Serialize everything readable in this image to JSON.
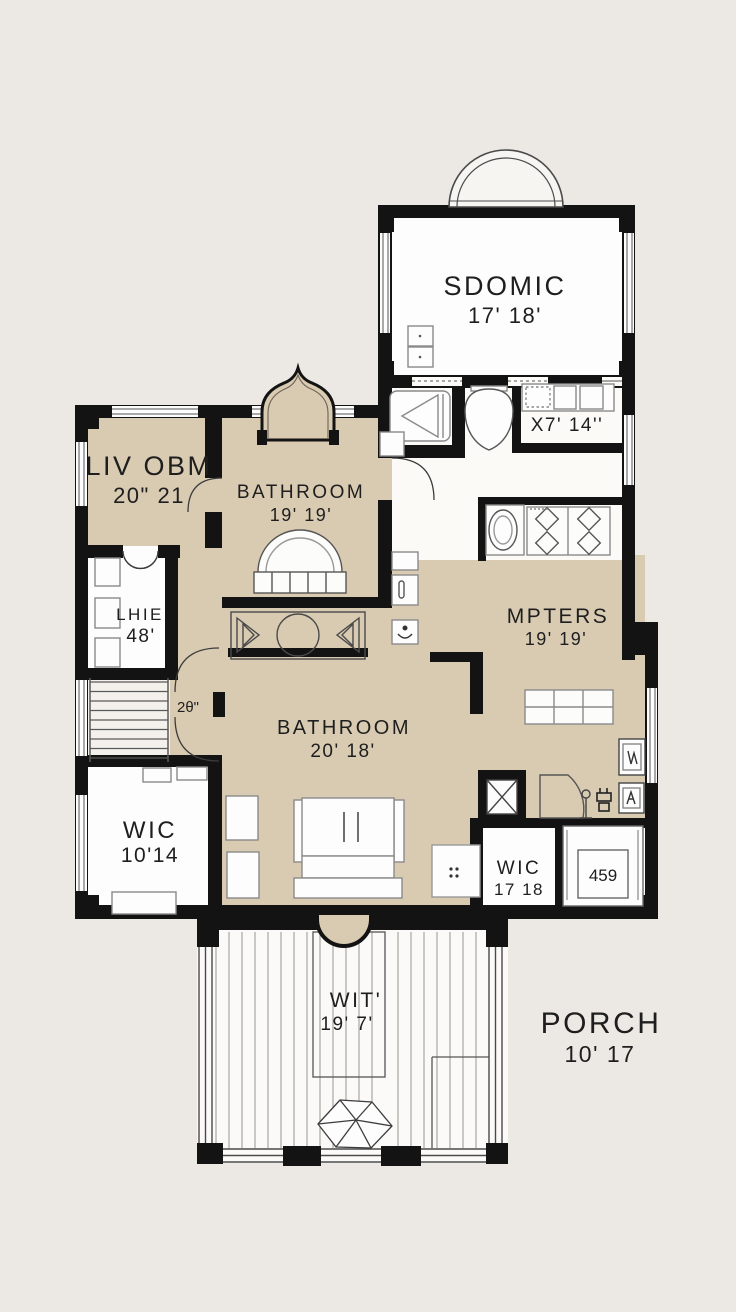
{
  "plan_title": "floor-plan",
  "rooms": {
    "top_bedroom": {
      "name": "SDOMIC",
      "dims": "17' 18'"
    },
    "closet_x7": {
      "dims": "X7' 14''"
    },
    "living": {
      "name": "LIV OBM",
      "dims": "20\" 21"
    },
    "upper_bathroom": {
      "name": "BATHROOM",
      "dims": "19' 19'"
    },
    "linen_closet": {
      "name": "LHIE",
      "dims": "48'"
    },
    "masters": {
      "name": "MPTERS",
      "dims": "19' 19'"
    },
    "main_bathroom": {
      "name": "BATHROOM",
      "dims": "20' 18'"
    },
    "wic_left": {
      "name": "WIC",
      "dims": "10'14"
    },
    "wic_right": {
      "name": "WIC",
      "dims": "17 18"
    },
    "deck": {
      "name": "WIT'",
      "dims": "19' 7'"
    },
    "porch": {
      "name": "PORCH",
      "dims": "10' 17"
    }
  },
  "annotations": {
    "door_width": "2θ\"",
    "bed_number": "459"
  },
  "colors": {
    "background": "#ECE9E4",
    "room_tan": "#D9CBB2",
    "room_white": "#FDFDFD",
    "wall_black": "#131313",
    "furniture_line": "#8a8a8a"
  },
  "icons": [
    "dome-bay-window-icon",
    "gothic-arch-bay-icon",
    "staircase-icon",
    "bathtub-icon",
    "toilet-icon",
    "stove-burners-icon",
    "sink-vanity-icon",
    "dining-table-icon",
    "sofa-icon",
    "wardrobe-icon",
    "bed-icon",
    "pillow-icon",
    "corner-desk-icon",
    "lamp-icon",
    "picture-frame-icon",
    "shaft-x-icon",
    "gem-decor-icon",
    "vent-dots-icon",
    "door-swing-icon",
    "window-icon"
  ]
}
